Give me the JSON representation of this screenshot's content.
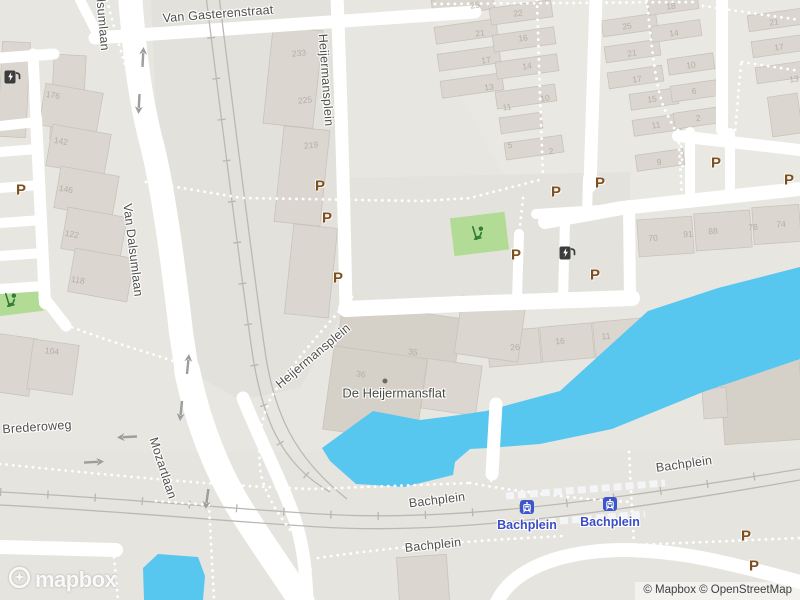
{
  "map": {
    "labels": [
      {
        "t": "Van Gasterenstraat",
        "x": 218,
        "y": 14,
        "r": -4.5,
        "c": "street"
      },
      {
        "t": "Van Dalsumlaan",
        "x": 101,
        "y": 4,
        "r": 85,
        "c": "street"
      },
      {
        "t": "Heijermansplein",
        "x": 326,
        "y": 80,
        "r": 86,
        "c": "street"
      },
      {
        "t": "Van Dalsumlaan",
        "x": 133,
        "y": 250,
        "r": 83,
        "c": "street"
      },
      {
        "t": "Heijermansplein",
        "x": 313,
        "y": 356,
        "r": -40,
        "c": "street"
      },
      {
        "t": "Mozartlaan",
        "x": 163,
        "y": 468,
        "r": 72,
        "c": "street"
      },
      {
        "t": "Brederoweg",
        "x": 37,
        "y": 427,
        "r": -4,
        "c": "street"
      },
      {
        "t": "Bachplein",
        "x": 684,
        "y": 464,
        "r": -8,
        "c": "street"
      },
      {
        "t": "Bachplein",
        "x": 437,
        "y": 500,
        "r": -7,
        "c": "street"
      },
      {
        "t": "Bachplein",
        "x": 433,
        "y": 545,
        "r": -6,
        "c": "street"
      },
      {
        "t": "De Heijermansflat",
        "x": 394,
        "y": 393,
        "r": 0,
        "c": "poi"
      },
      {
        "t": "Bachplein",
        "x": 527,
        "y": 525,
        "r": 0,
        "c": "stationlabel"
      },
      {
        "t": "Bachplein",
        "x": 610,
        "y": 522,
        "r": 0,
        "c": "stationlabel"
      },
      {
        "t": "233",
        "x": 299,
        "y": 53,
        "r": -6,
        "c": "num"
      },
      {
        "t": "225",
        "x": 305,
        "y": 100,
        "r": -6,
        "c": "num"
      },
      {
        "t": "219",
        "x": 311,
        "y": 145,
        "r": -6,
        "c": "num"
      },
      {
        "t": "176",
        "x": 53,
        "y": 95,
        "r": 10,
        "c": "num"
      },
      {
        "t": "142",
        "x": 61,
        "y": 141,
        "r": 10,
        "c": "num"
      },
      {
        "t": "146",
        "x": 66,
        "y": 189,
        "r": 10,
        "c": "num"
      },
      {
        "t": "122",
        "x": 72,
        "y": 234,
        "r": 10,
        "c": "num"
      },
      {
        "t": "118",
        "x": 78,
        "y": 280,
        "r": 10,
        "c": "num"
      },
      {
        "t": "104",
        "x": 52,
        "y": 351,
        "r": 5,
        "c": "num"
      },
      {
        "t": "36",
        "x": 361,
        "y": 374,
        "r": 8,
        "c": "num"
      },
      {
        "t": "35",
        "x": 413,
        "y": 352,
        "r": 8,
        "c": "num"
      },
      {
        "t": "25",
        "x": 475,
        "y": 5,
        "r": -8,
        "c": "num"
      },
      {
        "t": "22",
        "x": 518,
        "y": 13,
        "r": -8,
        "c": "num"
      },
      {
        "t": "21",
        "x": 480,
        "y": 33,
        "r": -8,
        "c": "num"
      },
      {
        "t": "16",
        "x": 523,
        "y": 38,
        "r": -8,
        "c": "num"
      },
      {
        "t": "17",
        "x": 486,
        "y": 60,
        "r": -8,
        "c": "num"
      },
      {
        "t": "14",
        "x": 527,
        "y": 66,
        "r": -8,
        "c": "num"
      },
      {
        "t": "13",
        "x": 489,
        "y": 87,
        "r": -8,
        "c": "num"
      },
      {
        "t": "10",
        "x": 545,
        "y": 98,
        "r": -8,
        "c": "num"
      },
      {
        "t": "11",
        "x": 507,
        "y": 107,
        "r": -8,
        "c": "num"
      },
      {
        "t": "5",
        "x": 510,
        "y": 145,
        "r": -8,
        "c": "num"
      },
      {
        "t": "2",
        "x": 551,
        "y": 151,
        "r": -8,
        "c": "num"
      },
      {
        "t": "25",
        "x": 627,
        "y": 26,
        "r": -8,
        "c": "num"
      },
      {
        "t": "21",
        "x": 632,
        "y": 53,
        "r": -8,
        "c": "num"
      },
      {
        "t": "17",
        "x": 637,
        "y": 79,
        "r": -8,
        "c": "num"
      },
      {
        "t": "15",
        "x": 652,
        "y": 99,
        "r": -8,
        "c": "num"
      },
      {
        "t": "11",
        "x": 656,
        "y": 125,
        "r": -8,
        "c": "num"
      },
      {
        "t": "9",
        "x": 659,
        "y": 162,
        "r": -8,
        "c": "num"
      },
      {
        "t": "18",
        "x": 671,
        "y": 6,
        "r": -8,
        "c": "num"
      },
      {
        "t": "14",
        "x": 674,
        "y": 33,
        "r": -8,
        "c": "num"
      },
      {
        "t": "10",
        "x": 691,
        "y": 65,
        "r": -8,
        "c": "num"
      },
      {
        "t": "6",
        "x": 694,
        "y": 91,
        "r": -8,
        "c": "num"
      },
      {
        "t": "2",
        "x": 698,
        "y": 118,
        "r": -8,
        "c": "num"
      },
      {
        "t": "21",
        "x": 774,
        "y": 22,
        "r": -8,
        "c": "num"
      },
      {
        "t": "17",
        "x": 779,
        "y": 47,
        "r": -8,
        "c": "num"
      },
      {
        "t": "13",
        "x": 794,
        "y": 79,
        "r": -8,
        "c": "num"
      },
      {
        "t": "26",
        "x": 515,
        "y": 347,
        "r": -5,
        "c": "num"
      },
      {
        "t": "16",
        "x": 560,
        "y": 341,
        "r": -5,
        "c": "num"
      },
      {
        "t": "11",
        "x": 606,
        "y": 336,
        "r": -5,
        "c": "num"
      },
      {
        "t": "70",
        "x": 653,
        "y": 238,
        "r": -4,
        "c": "num"
      },
      {
        "t": "91",
        "x": 688,
        "y": 234,
        "r": -4,
        "c": "num"
      },
      {
        "t": "88",
        "x": 713,
        "y": 231,
        "r": -4,
        "c": "num"
      },
      {
        "t": "78",
        "x": 753,
        "y": 227,
        "r": -4,
        "c": "num"
      },
      {
        "t": "74",
        "x": 781,
        "y": 224,
        "r": -4,
        "c": "num"
      }
    ],
    "parking_glyph": "P",
    "markers": [
      {
        "type": "parking",
        "x": 21,
        "y": 190
      },
      {
        "type": "parking",
        "x": 320,
        "y": 186
      },
      {
        "type": "parking",
        "x": 327,
        "y": 218
      },
      {
        "type": "parking",
        "x": 338,
        "y": 278
      },
      {
        "type": "parking",
        "x": 556,
        "y": 192
      },
      {
        "type": "parking",
        "x": 600,
        "y": 183
      },
      {
        "type": "parking",
        "x": 516,
        "y": 255
      },
      {
        "type": "parking",
        "x": 595,
        "y": 275
      },
      {
        "type": "parking",
        "x": 716,
        "y": 163
      },
      {
        "type": "parking",
        "x": 789,
        "y": 180
      },
      {
        "type": "parking",
        "x": 746,
        "y": 536
      },
      {
        "type": "parking",
        "x": 754,
        "y": 566
      },
      {
        "type": "ev",
        "x": 12,
        "y": 77
      },
      {
        "type": "ev",
        "x": 567,
        "y": 253
      },
      {
        "type": "playground",
        "x": 478,
        "y": 233
      },
      {
        "type": "playground",
        "x": 11,
        "y": 300
      },
      {
        "type": "station",
        "x": 527,
        "y": 507
      },
      {
        "type": "station",
        "x": 610,
        "y": 504
      },
      {
        "type": "poidot",
        "x": 385,
        "y": 381
      },
      {
        "type": "arrow",
        "x": 143,
        "y": 57,
        "r": 3
      },
      {
        "type": "arrow",
        "x": 139,
        "y": 104,
        "r": 183
      },
      {
        "type": "arrow",
        "x": 188,
        "y": 364,
        "r": 6
      },
      {
        "type": "arrow",
        "x": 181,
        "y": 411,
        "r": 186
      },
      {
        "type": "arrow",
        "x": 207,
        "y": 499,
        "r": 188
      },
      {
        "type": "arrow",
        "x": 127,
        "y": 437,
        "r": -93
      },
      {
        "type": "arrow",
        "x": 94,
        "y": 462,
        "r": 87
      }
    ],
    "colors": {
      "ground": "#e8e6e1",
      "road": "#ffffff",
      "building": "#dbd7d0",
      "building_dark": "#d5d1c9",
      "water": "#57c7f0",
      "green": "#b2dc96",
      "parking_brown": "#7d4f1f",
      "station_blue": "#3d56cb",
      "station_label_blue": "#3b4cc4",
      "street_label": "#4f4f4b",
      "rail": "#bcb9b3"
    },
    "logo_text": "mapbox",
    "attribution": "© Mapbox © OpenStreetMap"
  }
}
